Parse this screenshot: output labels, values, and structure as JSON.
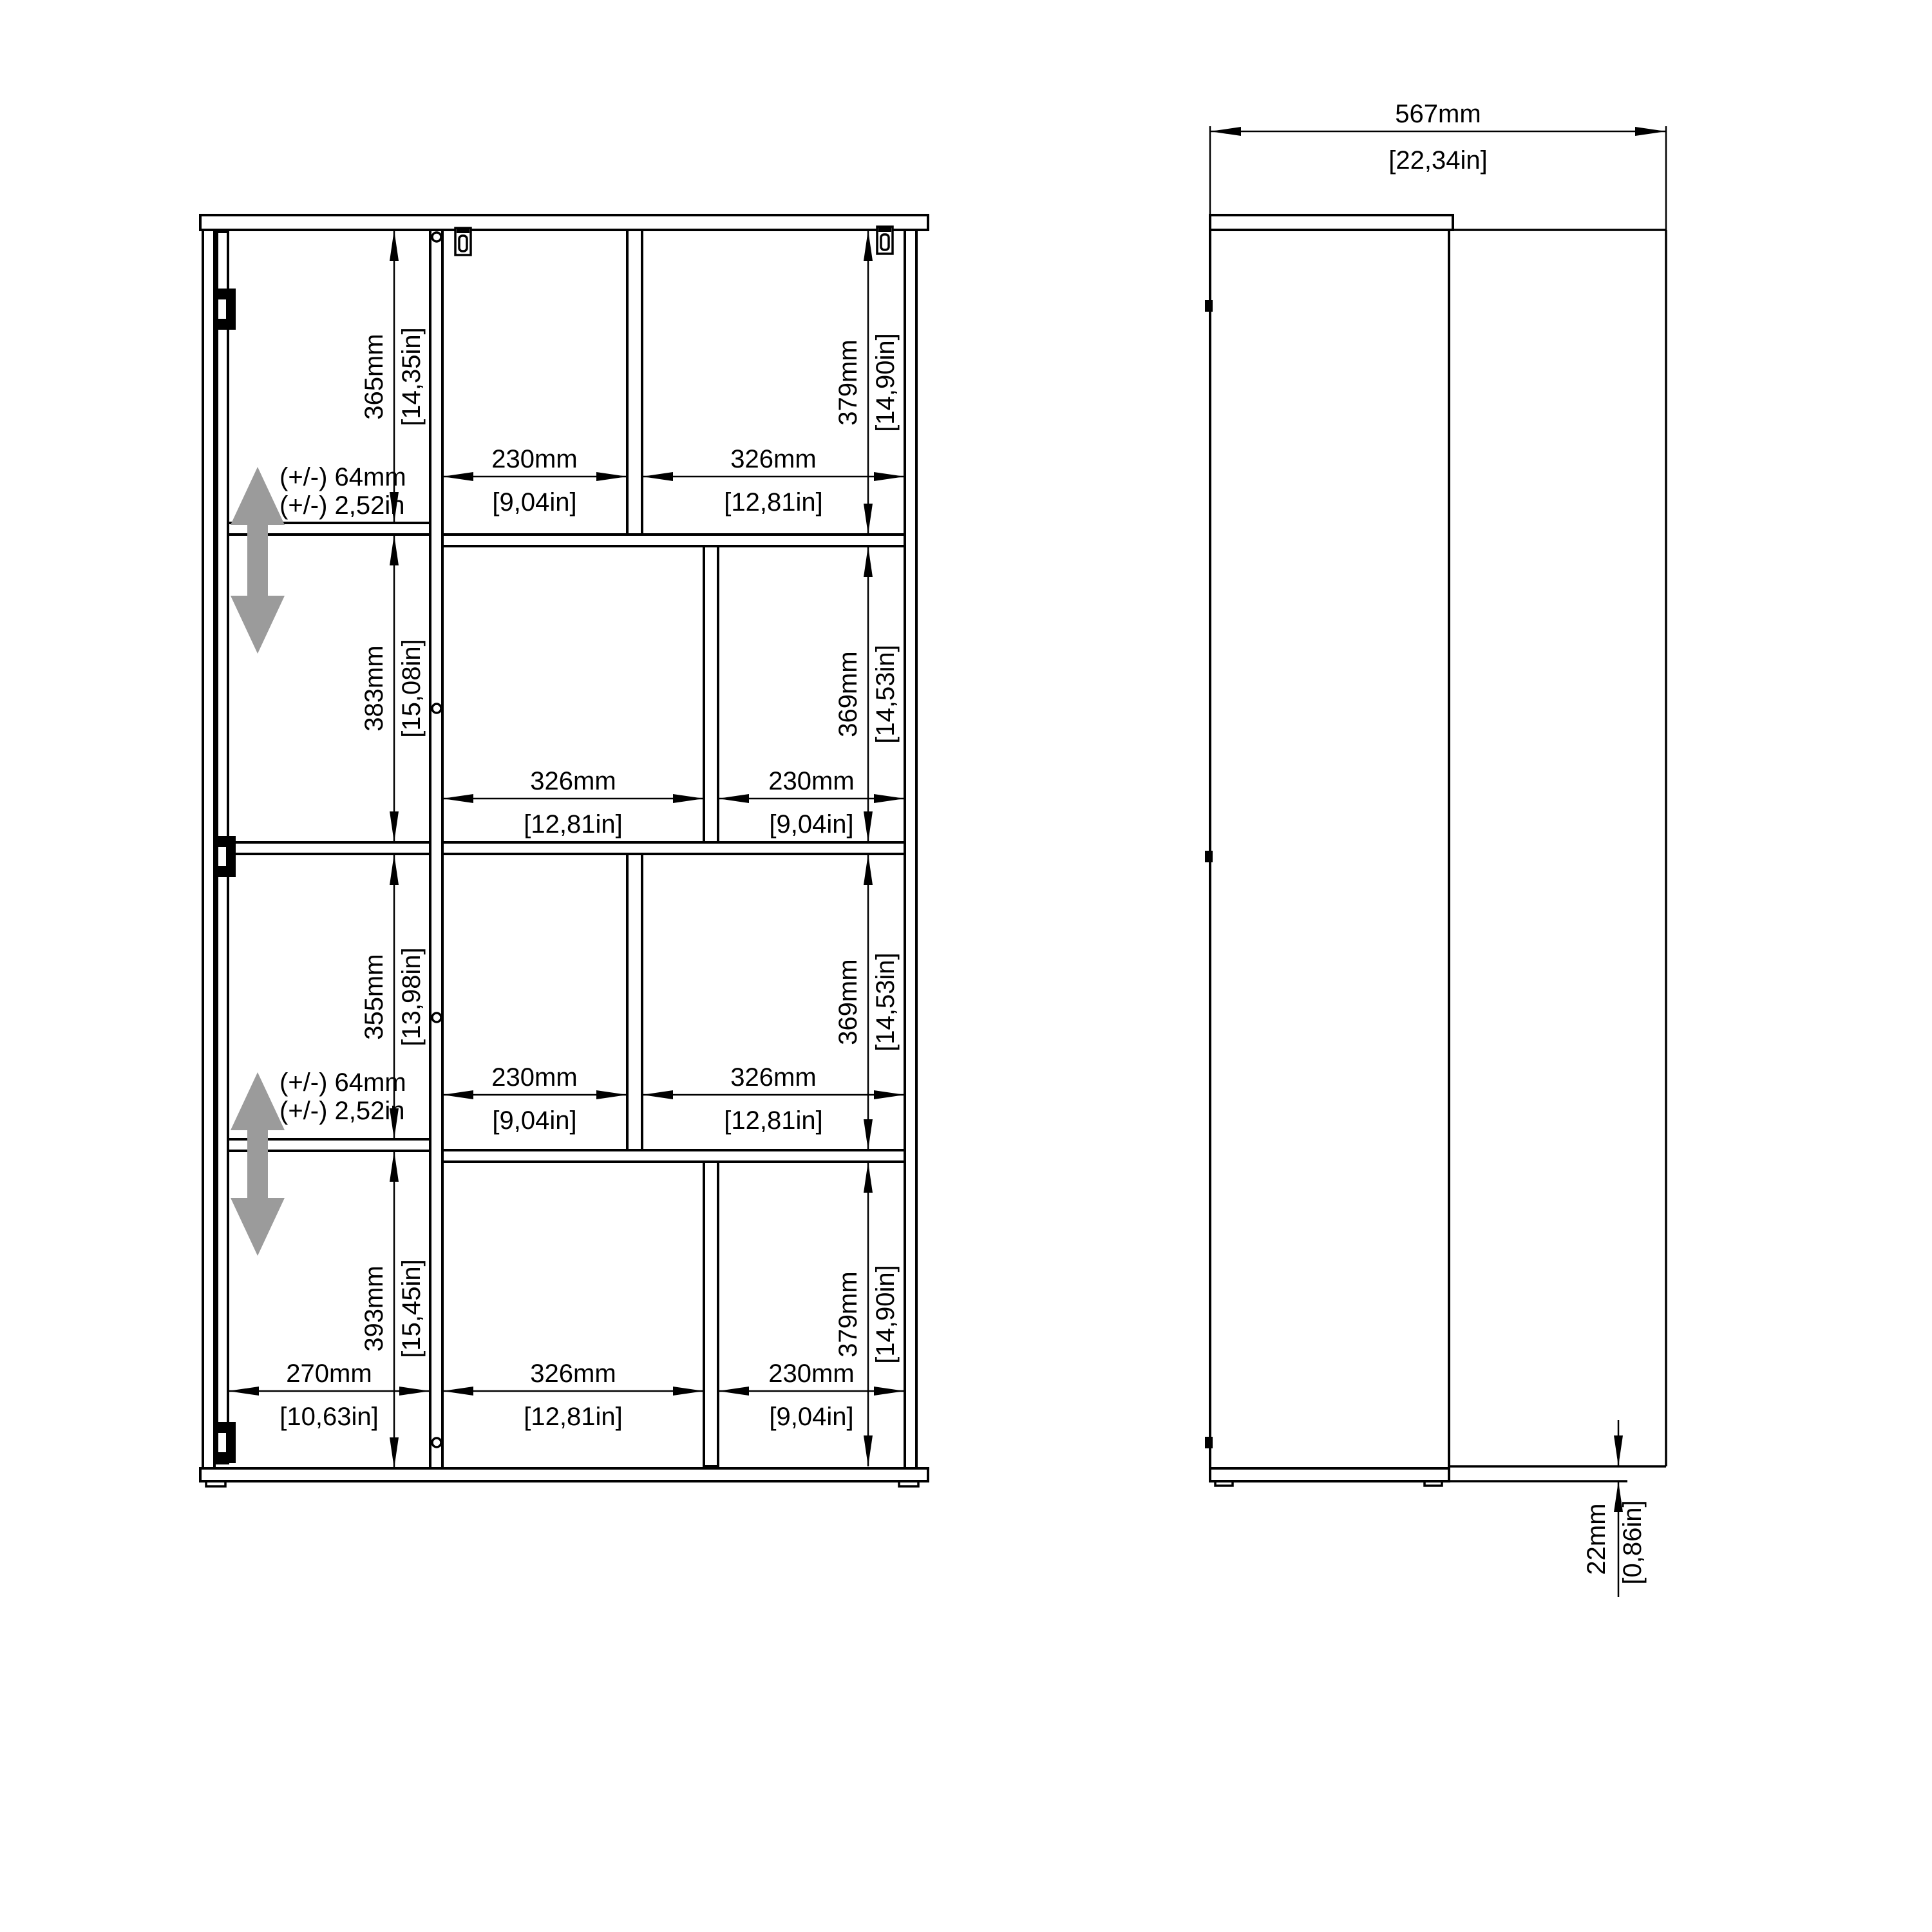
{
  "front_view": {
    "door_heights": [
      {
        "mm": "365mm",
        "in": "[14,35in]"
      },
      {
        "mm": "383mm",
        "in": "[15,08in]"
      },
      {
        "mm": "355mm",
        "in": "[13,98in]"
      },
      {
        "mm": "393mm",
        "in": "[15,45in]"
      }
    ],
    "right_heights": [
      {
        "mm": "379mm",
        "in": "[14,90in]"
      },
      {
        "mm": "369mm",
        "in": "[14,53in]"
      },
      {
        "mm": "369mm",
        "in": "[14,53in]"
      },
      {
        "mm": "379mm",
        "in": "[14,90in]"
      }
    ],
    "row1": {
      "w1": {
        "mm": "230mm",
        "in": "[9,04in]"
      },
      "w2": {
        "mm": "326mm",
        "in": "[12,81in]"
      }
    },
    "row2": {
      "w1": {
        "mm": "326mm",
        "in": "[12,81in]"
      },
      "w2": {
        "mm": "230mm",
        "in": "[9,04in]"
      }
    },
    "row3": {
      "w1": {
        "mm": "230mm",
        "in": "[9,04in]"
      },
      "w2": {
        "mm": "326mm",
        "in": "[12,81in]"
      }
    },
    "row4": {
      "w0": {
        "mm": "270mm",
        "in": "[10,63in]"
      },
      "w1": {
        "mm": "326mm",
        "in": "[12,81in]"
      },
      "w2": {
        "mm": "230mm",
        "in": "[9,04in]"
      }
    },
    "shelf_adjust": {
      "line1": "(+/-) 64mm",
      "line2": "(+/-) 2,52in"
    }
  },
  "side_view": {
    "depth": {
      "mm": "567mm",
      "in": "[22,34in]"
    },
    "plinth": {
      "mm": "22mm",
      "in": "[0,86in]"
    }
  },
  "colors": {
    "line": "#000000",
    "adjust_arrow_gray": "#9b9b9b",
    "background": "#ffffff"
  }
}
